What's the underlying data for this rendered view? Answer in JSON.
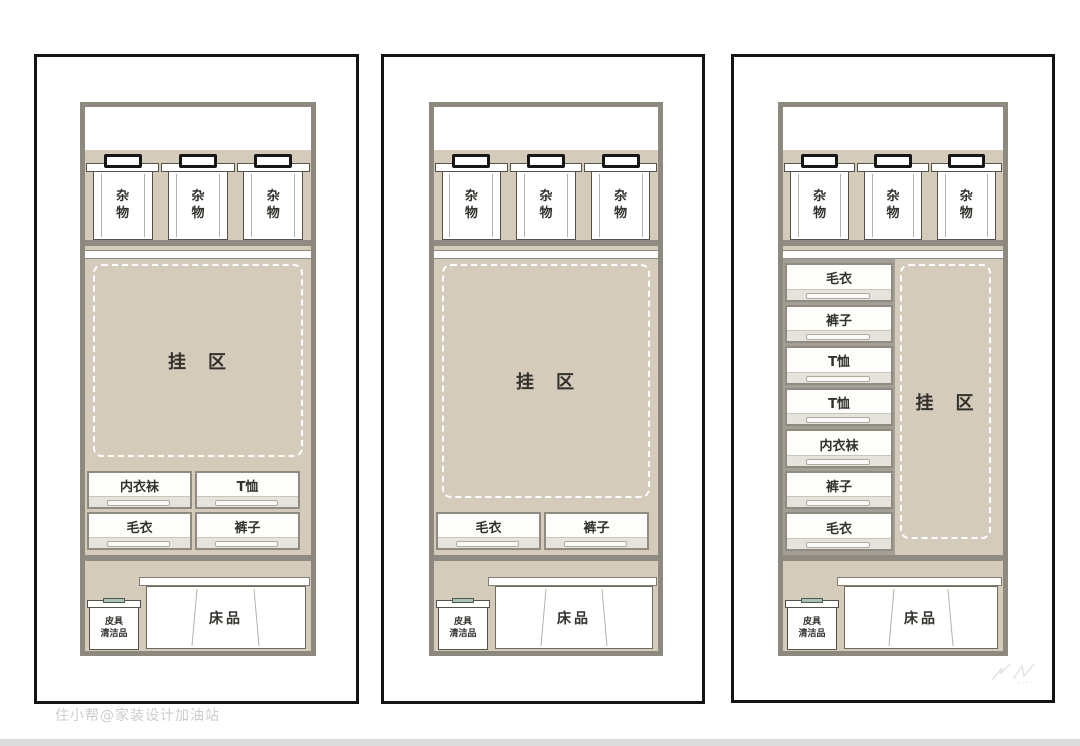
{
  "page": {
    "watermark": "住小帮@家装设计加油站",
    "colors": {
      "panel_border": "#141414",
      "wardrobe_frame": "#8d897f",
      "zone_fill": "#d4cbbb",
      "shelf_band": "#8f8b82",
      "box_clasp_teal": "#a8c3b6",
      "text": "#33312c"
    }
  },
  "panels": [
    {
      "id": "wardrobe-layout-1",
      "top_boxes": [
        "杂物",
        "杂物",
        "杂物"
      ],
      "hanging_zone_label": "挂　区",
      "drawer_rows": [
        [
          "内衣袜",
          "T恤"
        ],
        [
          "毛衣",
          "裤子"
        ]
      ],
      "leather_box": {
        "line1": "皮具",
        "line2": "清洁品"
      },
      "bedding_label": "床品"
    },
    {
      "id": "wardrobe-layout-2",
      "top_boxes": [
        "杂物",
        "杂物",
        "杂物"
      ],
      "hanging_zone_label": "挂　区",
      "drawer_rows": [
        [
          "毛衣",
          "裤子"
        ]
      ],
      "leather_box": {
        "line1": "皮具",
        "line2": "清洁品"
      },
      "bedding_label": "床品"
    },
    {
      "id": "wardrobe-layout-3",
      "top_boxes": [
        "杂物",
        "杂物",
        "杂物"
      ],
      "hanging_zone_label": "挂　区",
      "drawer_stack": [
        "毛衣",
        "裤子",
        "T恤",
        "T恤",
        "内衣袜",
        "裤子",
        "毛衣"
      ],
      "leather_box": {
        "line1": "皮具",
        "line2": "清洁品"
      },
      "bedding_label": "床品"
    }
  ]
}
